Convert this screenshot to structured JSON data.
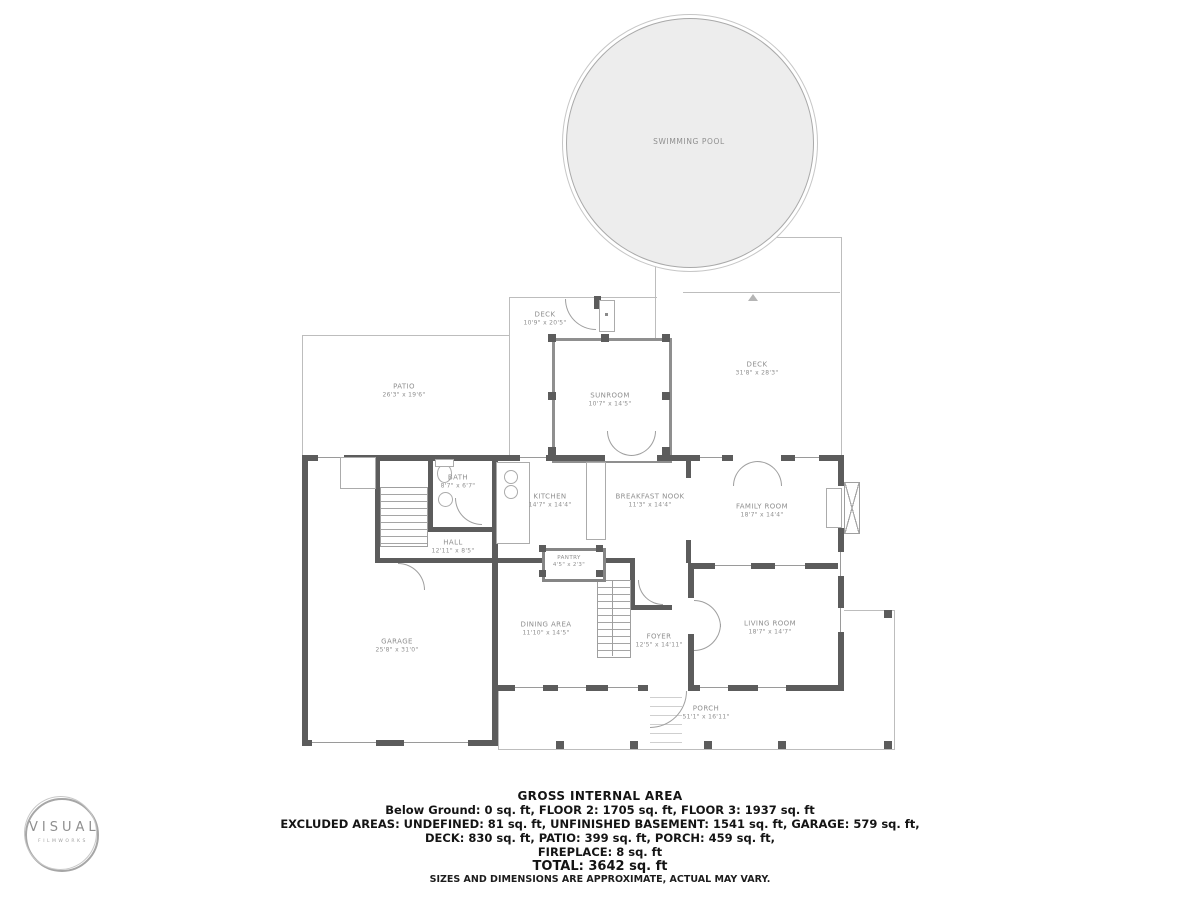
{
  "floorplan": {
    "rooms": {
      "swimming_pool": {
        "name": "SWIMMING POOL",
        "dims": ""
      },
      "deck_top": {
        "name": "DECK",
        "dims": "10'9\" x 20'5\""
      },
      "deck_right": {
        "name": "DECK",
        "dims": "31'8\" x 28'3\""
      },
      "sunroom": {
        "name": "SUNROOM",
        "dims": "10'7\" x 14'5\""
      },
      "patio": {
        "name": "PATIO",
        "dims": "26'3\" x 19'6\""
      },
      "kitchen": {
        "name": "KITCHEN",
        "dims": "14'7\" x 14'4\""
      },
      "breakfast_nook": {
        "name": "BREAKFAST NOOK",
        "dims": "11'3\" x 14'4\""
      },
      "family_room": {
        "name": "FAMILY ROOM",
        "dims": "18'7\" x 14'4\""
      },
      "bath": {
        "name": "BATH",
        "dims": "8'7\" x 6'7\""
      },
      "hall": {
        "name": "HALL",
        "dims": "12'11\" x 8'5\""
      },
      "pantry": {
        "name": "PANTRY",
        "dims": "4'5\" x 2'3\""
      },
      "garage": {
        "name": "GARAGE",
        "dims": "25'8\" x 31'0\""
      },
      "dining_area": {
        "name": "DINING AREA",
        "dims": "11'10\" x 14'5\""
      },
      "foyer": {
        "name": "FOYER",
        "dims": "12'5\" x 14'11\""
      },
      "living_room": {
        "name": "LIVING ROOM",
        "dims": "18'7\" x 14'7\""
      },
      "porch": {
        "name": "PORCH",
        "dims": "51'1\" x 16'11\""
      }
    }
  },
  "footer": {
    "title": "GROSS INTERNAL AREA",
    "line1": "Below Ground: 0 sq. ft, FLOOR 2: 1705 sq. ft, FLOOR 3: 1937 sq. ft",
    "line2": "EXCLUDED AREAS: UNDEFINED: 81 sq. ft, UNFINISHED BASEMENT: 1541 sq. ft, GARAGE: 579 sq. ft,",
    "line3": "DECK: 830 sq. ft, PATIO: 399 sq. ft, PORCH: 459 sq. ft,",
    "line4": "FIREPLACE: 8 sq. ft",
    "line5": "TOTAL: 3642 sq. ft",
    "disclaimer": "SIZES AND DIMENSIONS ARE APPROXIMATE, ACTUAL MAY VARY."
  },
  "logo": {
    "line1": "VISUAL",
    "line2": "FILMWORKS"
  },
  "colors": {
    "wall": "#5c5c5c",
    "thin_line": "#bdbdbd",
    "pool_fill": "#ededed",
    "label_text": "#8f8f8f",
    "footer_text": "#141414"
  }
}
